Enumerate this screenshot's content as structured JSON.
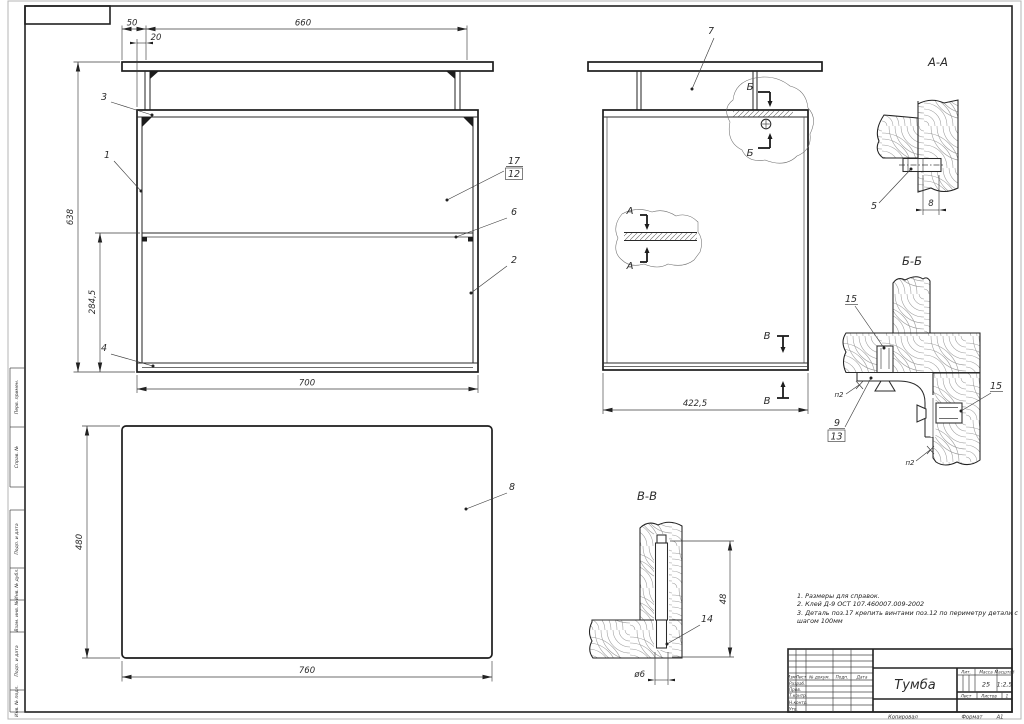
{
  "sheet": {
    "stamp_copied": "Копировал",
    "stamp_format_label": "Формат",
    "stamp_format_value": "А1",
    "margin": {
      "perv": "Перв. примен.",
      "sprav": "Справ. №",
      "podp1": "Подп. и дата",
      "inv_dubl": "Инв. № дубл.",
      "vzam": "Взам. инв. №",
      "podp2": "Подп. и дата",
      "inv_podl": "Инв. № подл."
    }
  },
  "front": {
    "d50": "50",
    "d20": "20",
    "d660": "660",
    "d638": "638",
    "d2845": "284,5",
    "d700": "700",
    "p1": "1",
    "p2": "2",
    "p3": "3",
    "p4": "4",
    "p6": "6",
    "p17": "17",
    "p12": "12"
  },
  "side": {
    "p7": "7",
    "d4225": "422,5",
    "mark_a": "А",
    "mark_b": "Б",
    "mark_v": "В"
  },
  "plan": {
    "p8": "8",
    "d760": "760",
    "d480": "480"
  },
  "secAA": {
    "title": "А-А",
    "p5": "5",
    "d8": "8"
  },
  "secBB": {
    "title": "Б-Б",
    "p15": "15",
    "p9": "9",
    "p13": "13",
    "glue": "п2"
  },
  "secVV": {
    "title": "В-В",
    "p14": "14",
    "d48": "48",
    "dia": "ø6"
  },
  "notes": {
    "n1": "1. Размеры для справок.",
    "n2": "2. Клей Д-9 ОСТ 107.460007.009-2002",
    "n3": "3. Деталь поз.17 крепить винтами поз.12 по периметру детали с шагом 100мм"
  },
  "tb": {
    "name": "Тумба",
    "h_izm": "Изм.",
    "h_list": "Лист",
    "h_ndok": "№ докум.",
    "h_podp": "Подп.",
    "h_data": "Дата",
    "r_razrab": "Разраб.",
    "r_prov": "Пров.",
    "r_tkontr": "Т.контр.",
    "r_nkontr": "Н.контр.",
    "r_utv": "Утв.",
    "h_lit": "Лит.",
    "h_massa": "Масса",
    "h_masshtab": "Масштаб",
    "v_massa": "25",
    "v_masshtab": "1:2,5",
    "h_list2": "Лист",
    "h_listov": "Листов",
    "v_listov": "1"
  }
}
